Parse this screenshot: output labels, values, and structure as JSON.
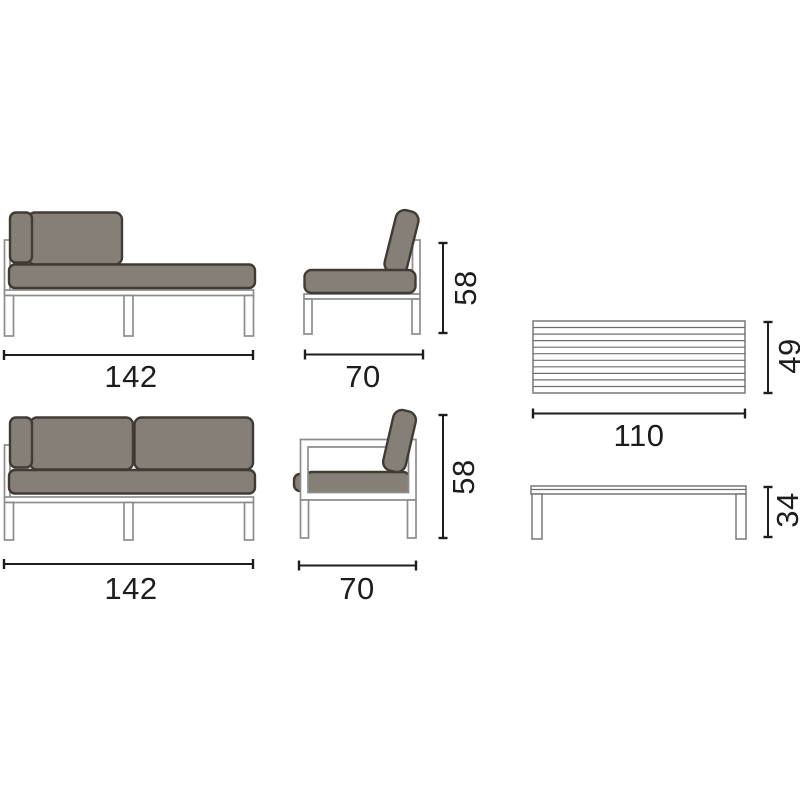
{
  "colors": {
    "background": "#ffffff",
    "cushion_fill": "#867f77",
    "cushion_outline": "#403b35",
    "frame_outline": "#8d8d8d",
    "table_outline": "#787878",
    "dimension_line": "#1d1d1d",
    "label_text": "#1d1d1d"
  },
  "labels": {
    "chaise_width": "142",
    "seat_width": "70",
    "seat_height": "58",
    "table_width": "110",
    "table_depth": "49",
    "sofa_width": "142",
    "armchair_width": "70",
    "armchair_height": "58",
    "table_height": "34"
  }
}
